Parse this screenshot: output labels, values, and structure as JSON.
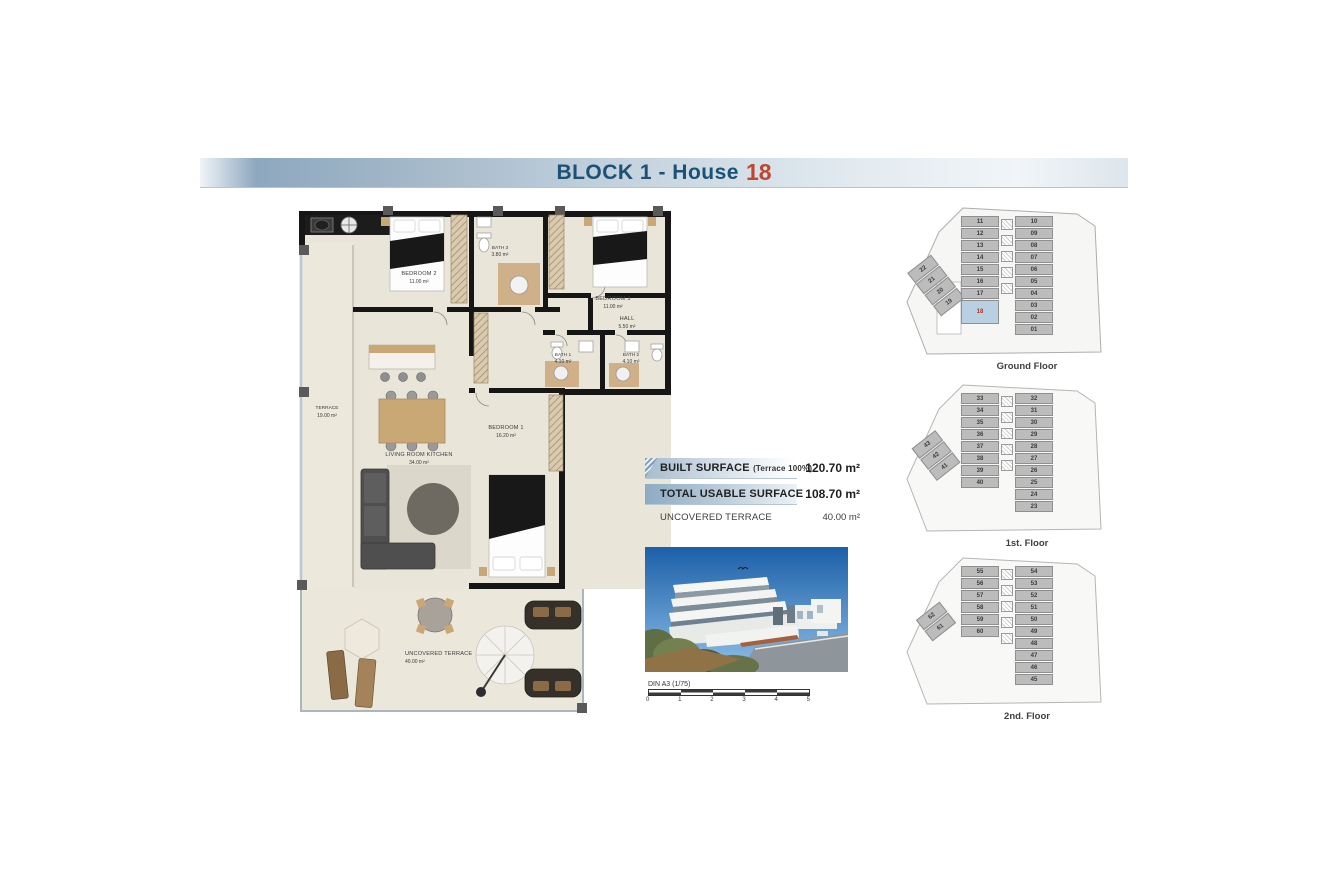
{
  "title": {
    "block": "BLOCK 1 - House",
    "house_number": "18"
  },
  "colors": {
    "title_text": "#1d5174",
    "house_number_red": "#bf4730",
    "bar_blue": "#8cabc3",
    "highlight_unit_blue": "#b9cfe2",
    "unit_number_red": "#b4341f",
    "wall_black": "#161616",
    "floor_beige": "#e9e5d9",
    "wood_tan": "#c9a876"
  },
  "floorplan": {
    "rooms": [
      {
        "name": "BEDROOM 2",
        "area": "11.00 m²"
      },
      {
        "name": "BATH 3",
        "area": "3.80 m²"
      },
      {
        "name": "BEDROOM 3",
        "area": "11.00 m²"
      },
      {
        "name": "HALL",
        "area": "5.50 m²"
      },
      {
        "name": "BATH 1",
        "area": "4.10 m²"
      },
      {
        "name": "BATH 2",
        "area": "4.10 m²"
      },
      {
        "name": "LIVING ROOM KITCHEN",
        "area": "34.00 m²"
      },
      {
        "name": "BEDROOM 1",
        "area": "16.20 m²"
      },
      {
        "name": "TERRACE",
        "area": "19.00 m²"
      },
      {
        "name": "UNCOVERED TERRACE",
        "area": "40.00 m²"
      }
    ]
  },
  "surfaces": {
    "rows": [
      {
        "label": "BUILT SURFACE",
        "note": "(Terrace 100%)",
        "value": "120.70 m²"
      },
      {
        "label": "TOTAL USABLE SURFACE",
        "note": "",
        "value": "108.70 m²"
      },
      {
        "label": "UNCOVERED TERRACE",
        "note": "",
        "value": "40.00 m²"
      }
    ]
  },
  "scale": {
    "label": "DIN A3 (1/75)",
    "ticks": [
      "0",
      "1",
      "2",
      "3",
      "4",
      "5"
    ]
  },
  "floors": [
    {
      "label": "Ground Floor",
      "left": [
        {
          "label": "11"
        },
        {
          "label": "12"
        },
        {
          "label": "13"
        },
        {
          "label": "14"
        },
        {
          "label": "15"
        },
        {
          "label": "16"
        },
        {
          "label": "17"
        },
        {
          "label": "18",
          "highlight": true
        }
      ],
      "right": [
        {
          "label": "10"
        },
        {
          "label": "09"
        },
        {
          "label": "08"
        },
        {
          "label": "07"
        },
        {
          "label": "06"
        },
        {
          "label": "05"
        },
        {
          "label": "04"
        },
        {
          "label": "03"
        },
        {
          "label": "02"
        },
        {
          "label": "01"
        }
      ],
      "angled": [
        {
          "label": "22"
        },
        {
          "label": "21"
        },
        {
          "label": "20"
        },
        {
          "label": "19"
        }
      ]
    },
    {
      "label": "1st. Floor",
      "left": [
        {
          "label": "33"
        },
        {
          "label": "34"
        },
        {
          "label": "35"
        },
        {
          "label": "36"
        },
        {
          "label": "37"
        },
        {
          "label": "38"
        },
        {
          "label": "39"
        },
        {
          "label": "40"
        }
      ],
      "right": [
        {
          "label": "32"
        },
        {
          "label": "31"
        },
        {
          "label": "30"
        },
        {
          "label": "29"
        },
        {
          "label": "28"
        },
        {
          "label": "27"
        },
        {
          "label": "26"
        },
        {
          "label": "25"
        },
        {
          "label": "24"
        },
        {
          "label": "23"
        }
      ],
      "angled": [
        {
          "label": "43"
        },
        {
          "label": "42"
        },
        {
          "label": "41"
        }
      ]
    },
    {
      "label": "2nd. Floor",
      "left": [
        {
          "label": "55"
        },
        {
          "label": "56"
        },
        {
          "label": "57"
        },
        {
          "label": "58"
        },
        {
          "label": "59"
        },
        {
          "label": "60"
        }
      ],
      "right": [
        {
          "label": "54"
        },
        {
          "label": "53"
        },
        {
          "label": "52"
        },
        {
          "label": "51"
        },
        {
          "label": "50"
        },
        {
          "label": "49"
        },
        {
          "label": "48"
        },
        {
          "label": "47"
        },
        {
          "label": "46"
        },
        {
          "label": "45"
        }
      ],
      "angled": [
        {
          "label": "62"
        },
        {
          "label": "61"
        }
      ]
    }
  ]
}
